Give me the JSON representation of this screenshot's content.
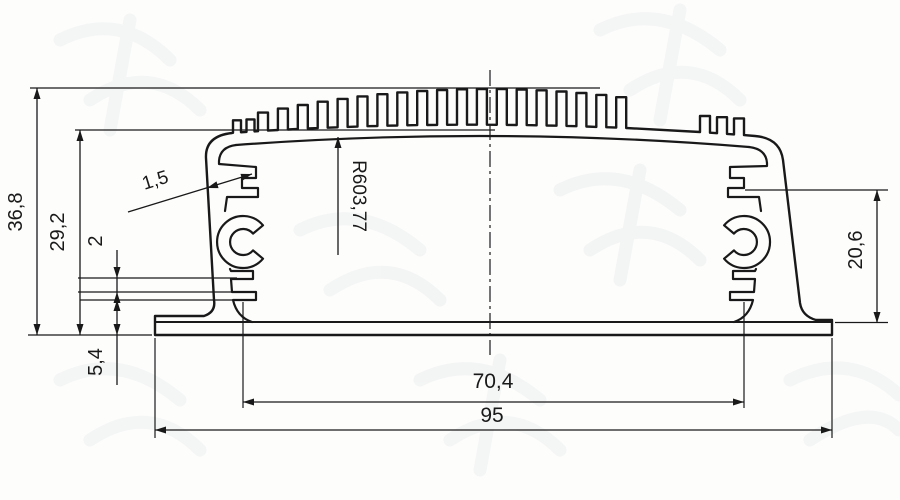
{
  "drawing": {
    "type": "aluminum-extrusion-profile-cross-section",
    "dimensions": {
      "overall_height": "36,8",
      "inner_height": "29,2",
      "pcb_slot_gap": "2",
      "base_height": "5,4",
      "wall_thickness": "1,5",
      "top_radius": "R603,77",
      "right_inner_height": "20,6",
      "inner_width": "70,4",
      "overall_width": "95"
    },
    "colors": {
      "line": "#191919",
      "background": "#fdfdfc"
    },
    "profile": {
      "fin_fields": [
        {
          "start": 233,
          "count": 2,
          "period": 13.5,
          "width": 8,
          "height": 12
        },
        {
          "start": 258,
          "count": 19,
          "period": 19.9,
          "width": 10,
          "height": null
        },
        {
          "start": 700,
          "count": 3,
          "period": 17,
          "width": 10,
          "height": 16
        }
      ],
      "base_arc": {
        "x0": 230,
        "y0": 133,
        "cx": 492,
        "cy": 115,
        "x1": 755,
        "y1": 136
      },
      "top_arc": {
        "x0": 230,
        "y0": 120,
        "cx": 492,
        "cy": 57,
        "x1": 755,
        "y1": 122
      }
    }
  }
}
